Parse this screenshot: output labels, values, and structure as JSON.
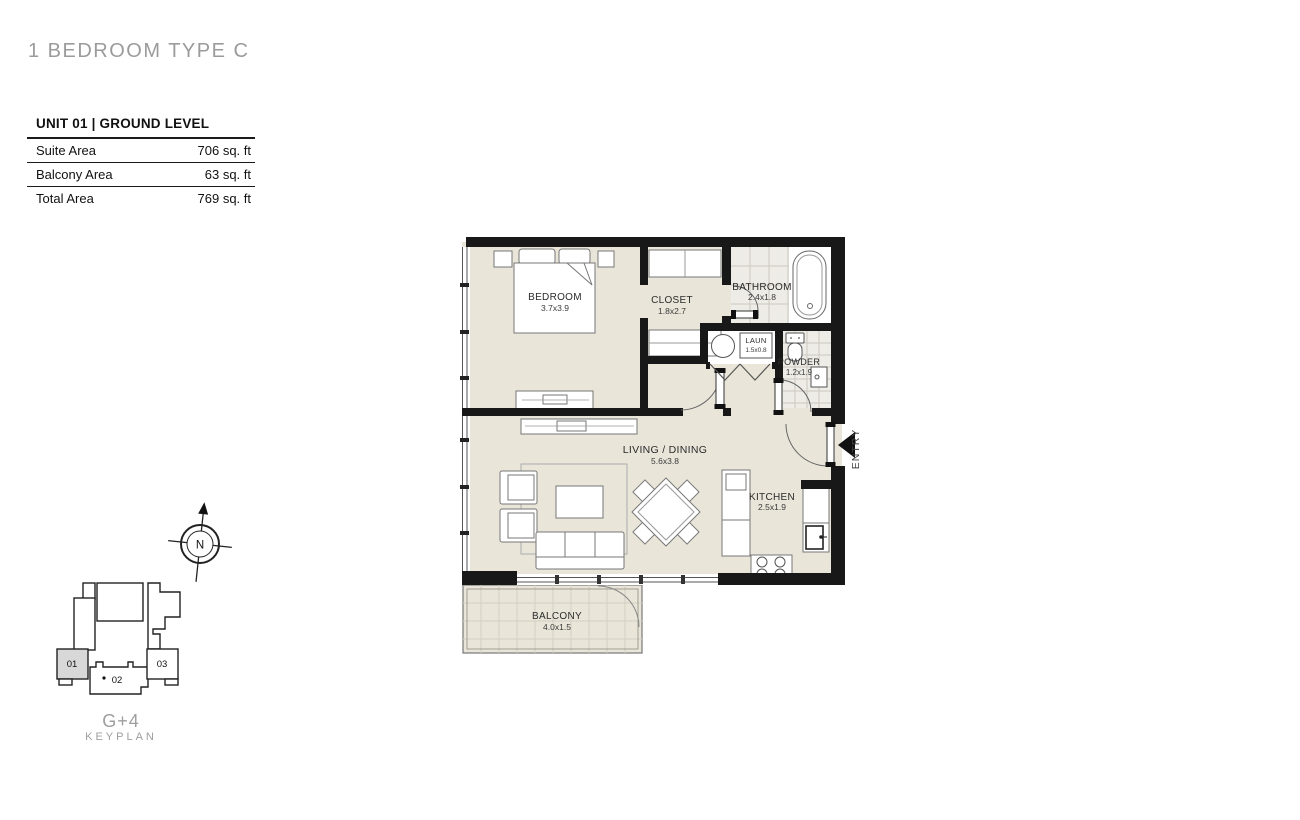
{
  "page": {
    "title": "1 BEDROOM TYPE C"
  },
  "unit_info": {
    "header": "UNIT 01 | GROUND LEVEL",
    "rows": [
      {
        "label": "Suite Area",
        "value": "706 sq. ft"
      },
      {
        "label": "Balcony Area",
        "value": "63 sq. ft"
      },
      {
        "label": "Total Area",
        "value": "769 sq. ft"
      }
    ]
  },
  "floor_plan": {
    "rooms": [
      {
        "name": "BEDROOM",
        "dimensions": "3.7x3.9"
      },
      {
        "name": "CLOSET",
        "dimensions": "1.8x2.7"
      },
      {
        "name": "BATHROOM",
        "dimensions": "2.4x1.8"
      },
      {
        "name": "LAUN",
        "dimensions": "1.5x0.8"
      },
      {
        "name": "POWDER",
        "dimensions": "1.2x1.9"
      },
      {
        "name": "LIVING / DINING",
        "dimensions": "5.6x3.8"
      },
      {
        "name": "KITCHEN",
        "dimensions": "2.5x1.9"
      },
      {
        "name": "BALCONY",
        "dimensions": "4.0x1.5"
      }
    ],
    "entry_label": "ENTRY",
    "compass_label": "N"
  },
  "keyplan": {
    "units": [
      {
        "id": "01",
        "highlighted": true
      },
      {
        "id": "02",
        "highlighted": false
      },
      {
        "id": "03",
        "highlighted": false
      }
    ],
    "building_label": "G+4",
    "caption": "KEYPLAN"
  },
  "colors": {
    "wall": "#181818",
    "floor": "#e9e5d9",
    "tile": "#edece6",
    "highlight": "#d8d8d8",
    "title_gray": "#9b9b9b"
  }
}
